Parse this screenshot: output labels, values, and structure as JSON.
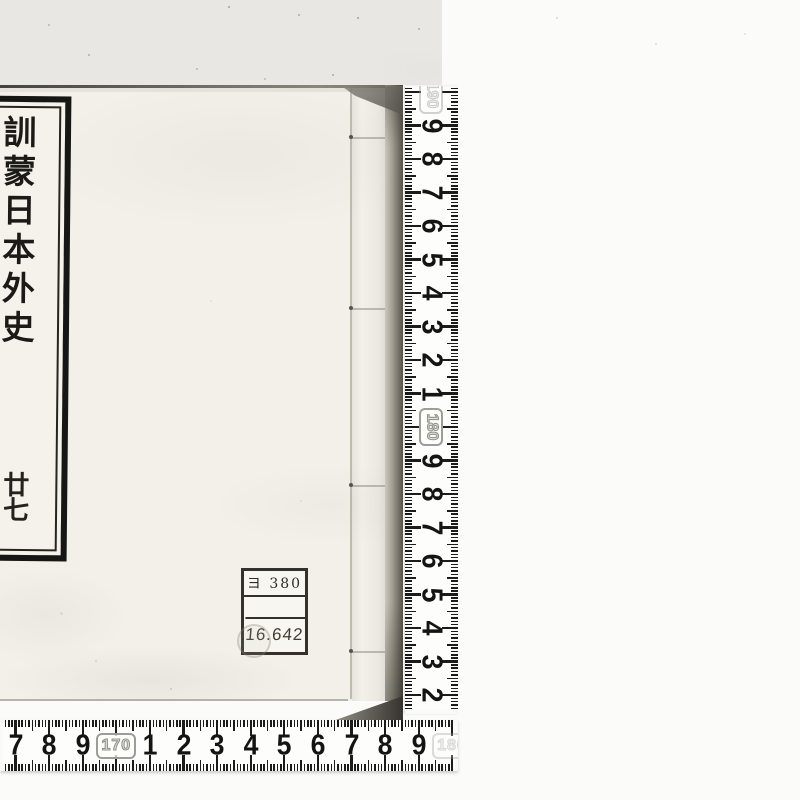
{
  "book": {
    "title_slip": {
      "chars": [
        "訓",
        "蒙",
        "日",
        "本",
        "外",
        "史"
      ],
      "volume_chars": [
        "廿",
        "七"
      ]
    },
    "call_number_label": {
      "rows": [
        "ヨ 380",
        "",
        "16.642"
      ]
    }
  },
  "rulers": {
    "unit": "cm",
    "vertical": {
      "top_badge": "190",
      "marks": [
        "9",
        "8",
        "7",
        "6",
        "5",
        "4",
        "3",
        "2",
        "1",
        "180",
        "9",
        "8",
        "7",
        "6",
        "5",
        "4",
        "3",
        "2"
      ]
    },
    "horizontal": {
      "marks": [
        "7",
        "8",
        "9",
        "170",
        "1",
        "2",
        "3",
        "4",
        "5",
        "6",
        "7",
        "8",
        "9"
      ],
      "end_badge": "180"
    }
  },
  "colors": {
    "cover": "#f2f0e9",
    "backdrop": "#e8e7e3",
    "background": "#fbfbfa",
    "edge_dark": "#565349",
    "ink": "#1b1a17"
  }
}
